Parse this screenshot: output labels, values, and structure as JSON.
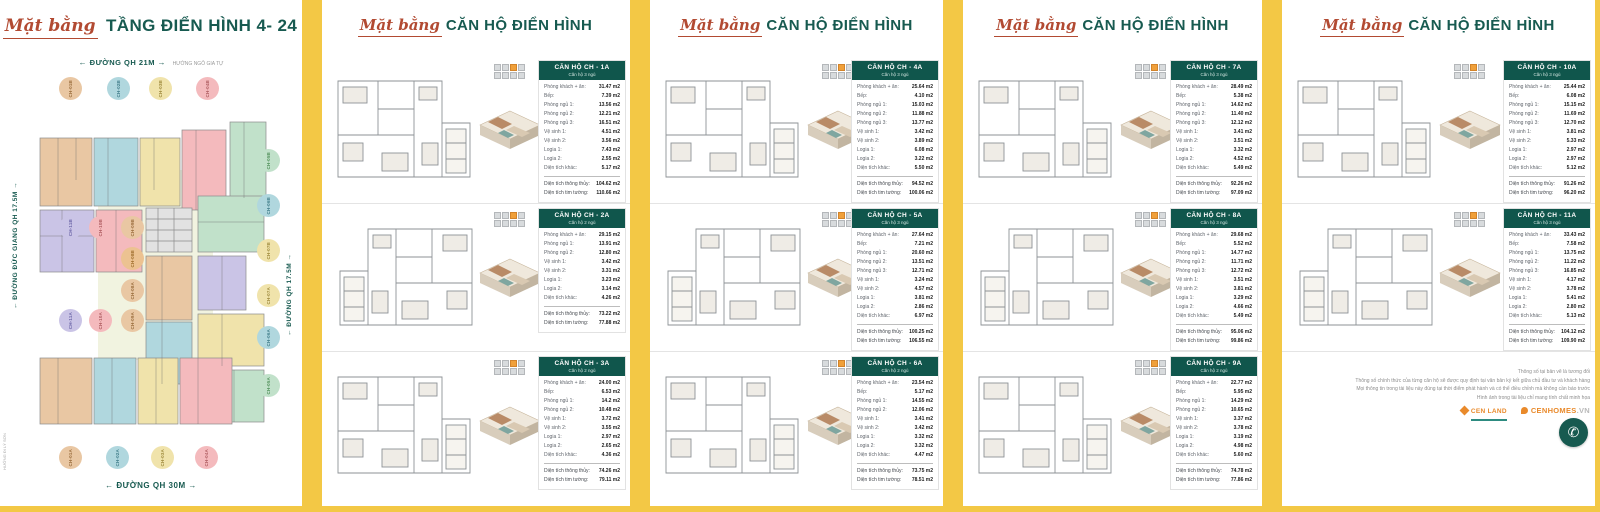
{
  "colors": {
    "yellow": "#f3c845",
    "teal": "#175a50",
    "script_red": "#b24a32",
    "orange": "#e98a2b",
    "header_teal": "#10564c"
  },
  "left_panel": {
    "title_script": "Mặt bằng",
    "title_main": "TẦNG ĐIỂN HÌNH 4- 24",
    "street_top": "ĐƯỜNG QH 21M",
    "street_top_note": "HƯỚNG NGÔ GIA TỰ",
    "street_bottom": "ĐƯỜNG QH 30M",
    "street_left": "ĐƯỜNG ĐỨC GIANG QH 17.5M",
    "street_left_note": "HƯỚNG ĐI LÝ SƠN",
    "street_right": "ĐƯỜNG QH 17.5M",
    "bubbles": [
      {
        "label": "CH-01B",
        "c": "tan",
        "x": 70,
        "y": 88
      },
      {
        "label": "CH-02B",
        "c": "blue",
        "x": 118,
        "y": 88
      },
      {
        "label": "CH-03B",
        "c": "yellow",
        "x": 160,
        "y": 88
      },
      {
        "label": "CH-04B",
        "c": "rose",
        "x": 207,
        "y": 88
      },
      {
        "label": "CH-11B",
        "c": "purple",
        "x": 70,
        "y": 227
      },
      {
        "label": "CH-10B",
        "c": "rose",
        "x": 100,
        "y": 227
      },
      {
        "label": "CH-09B",
        "c": "tan",
        "x": 132,
        "y": 227
      },
      {
        "label": "CH-08B",
        "c": "orange",
        "x": 132,
        "y": 258
      },
      {
        "label": "CH-08A",
        "c": "tan",
        "x": 132,
        "y": 290
      },
      {
        "label": "CH-11A",
        "c": "purple",
        "x": 70,
        "y": 320
      },
      {
        "label": "CH-10A",
        "c": "rose",
        "x": 100,
        "y": 320
      },
      {
        "label": "CH-09A",
        "c": "tan",
        "x": 132,
        "y": 320
      },
      {
        "label": "CH-05B",
        "c": "green",
        "x": 268,
        "y": 160
      },
      {
        "label": "CH-06B",
        "c": "blue",
        "x": 268,
        "y": 205
      },
      {
        "label": "CH-07B",
        "c": "yellow",
        "x": 268,
        "y": 250
      },
      {
        "label": "CH-07A",
        "c": "yellow",
        "x": 268,
        "y": 295
      },
      {
        "label": "CH-06A",
        "c": "blue",
        "x": 268,
        "y": 337
      },
      {
        "label": "CH-05A",
        "c": "green",
        "x": 268,
        "y": 385
      },
      {
        "label": "CH-01A",
        "c": "tan",
        "x": 70,
        "y": 457
      },
      {
        "label": "CH-02A",
        "c": "blue",
        "x": 117,
        "y": 457
      },
      {
        "label": "CH-03A",
        "c": "yellow",
        "x": 162,
        "y": 457
      },
      {
        "label": "CH-04A",
        "c": "rose",
        "x": 206,
        "y": 457
      }
    ]
  },
  "panels": [
    {
      "title_script": "Mặt bằng",
      "title_main": "CĂN HỘ ĐIỂN HÌNH",
      "units": [
        {
          "id": "CĂN HỘ CH - 1A",
          "subtitle": "Căn hộ 3 ngủ",
          "rows": [
            [
              "Phòng khách + ăn:",
              "31.47 m2"
            ],
            [
              "Bếp:",
              "7.39 m2"
            ],
            [
              "Phòng ngủ 1:",
              "13.56 m2"
            ],
            [
              "Phòng ngủ 2:",
              "12.21 m2"
            ],
            [
              "Phòng ngủ 3:",
              "16.51 m2"
            ],
            [
              "Vệ sinh 1:",
              "4.51 m2"
            ],
            [
              "Vệ sinh 2:",
              "3.56 m2"
            ],
            [
              "Logia 1:",
              "7.43 m2"
            ],
            [
              "Logia 2:",
              "2.55 m2"
            ],
            [
              "Diện tích khác:",
              "5.17 m2"
            ]
          ],
          "totals": [
            [
              "Diện tích thông thủy:",
              "104.62 m2"
            ],
            [
              "Diện tích tim tường:",
              "110.66 m2"
            ]
          ]
        },
        {
          "id": "CĂN HỘ CH - 2A",
          "subtitle": "Căn hộ 2 ngủ",
          "rows": [
            [
              "Phòng khách + ăn:",
              "29.15 m2"
            ],
            [
              "Phòng ngủ 1:",
              "13.91 m2"
            ],
            [
              "Phòng ngủ 2:",
              "12.80 m2"
            ],
            [
              "Vệ sinh 1:",
              "3.42 m2"
            ],
            [
              "Vệ sinh 2:",
              "3.31 m2"
            ],
            [
              "Logia 1:",
              "3.23 m2"
            ],
            [
              "Logia 2:",
              "3.14 m2"
            ],
            [
              "Diện tích khác:",
              "4.26 m2"
            ]
          ],
          "totals": [
            [
              "Diện tích thông thủy:",
              "73.22 m2"
            ],
            [
              "Diện tích tim tường:",
              "77.88 m2"
            ]
          ]
        },
        {
          "id": "CĂN HỘ CH - 3A",
          "subtitle": "Căn hộ 2 ngủ",
          "rows": [
            [
              "Phòng khách + ăn:",
              "24.00 m2"
            ],
            [
              "Bếp:",
              "6.53 m2"
            ],
            [
              "Phòng ngủ 1:",
              "14.2 m2"
            ],
            [
              "Phòng ngủ 2:",
              "10.48 m2"
            ],
            [
              "Vệ sinh 1:",
              "3.72 m2"
            ],
            [
              "Vệ sinh 2:",
              "3.55 m2"
            ],
            [
              "Logia 1:",
              "2.97 m2"
            ],
            [
              "Logia 2:",
              "2.65 m2"
            ],
            [
              "Diện tích khác:",
              "4.36 m2"
            ]
          ],
          "totals": [
            [
              "Diện tích thông thủy:",
              "74.26 m2"
            ],
            [
              "Diện tích tim tường:",
              "79.11 m2"
            ]
          ]
        }
      ]
    },
    {
      "title_script": "Mặt bằng",
      "title_main": "CĂN HỘ ĐIỂN HÌNH",
      "units": [
        {
          "id": "CĂN HỘ CH - 4A",
          "subtitle": "Căn hộ 3 ngủ",
          "rows": [
            [
              "Phòng khách + ăn:",
              "25.64 m2"
            ],
            [
              "Bếp:",
              "4.10 m2"
            ],
            [
              "Phòng ngủ 1:",
              "15.03 m2"
            ],
            [
              "Phòng ngủ 2:",
              "11.88 m2"
            ],
            [
              "Phòng ngủ 3:",
              "13.77 m2"
            ],
            [
              "Vệ sinh 1:",
              "3.42 m2"
            ],
            [
              "Vệ sinh 2:",
              "3.89 m2"
            ],
            [
              "Logia 1:",
              "6.08 m2"
            ],
            [
              "Logia 2:",
              "3.22 m2"
            ],
            [
              "Diện tích khác:",
              "5.50 m2"
            ]
          ],
          "totals": [
            [
              "Diện tích thông thủy:",
              "94.52 m2"
            ],
            [
              "Diện tích tim tường:",
              "100.06 m2"
            ]
          ]
        },
        {
          "id": "CĂN HỘ CH - 5A",
          "subtitle": "Căn hộ 3 ngủ",
          "rows": [
            [
              "Phòng khách + ăn:",
              "27.64 m2"
            ],
            [
              "Bếp:",
              "7.21 m2"
            ],
            [
              "Phòng ngủ 1:",
              "20.60 m2"
            ],
            [
              "Phòng ngủ 2:",
              "13.51 m2"
            ],
            [
              "Phòng ngủ 3:",
              "12.71 m2"
            ],
            [
              "Vệ sinh 1:",
              "3.24 m2"
            ],
            [
              "Vệ sinh 2:",
              "4.57 m2"
            ],
            [
              "Logia 1:",
              "3.81 m2"
            ],
            [
              "Logia 2:",
              "2.86 m2"
            ],
            [
              "Diện tích khác:",
              "6.97 m2"
            ]
          ],
          "totals": [
            [
              "Diện tích thông thủy:",
              "100.25 m2"
            ],
            [
              "Diện tích tim tường:",
              "106.55 m2"
            ]
          ]
        },
        {
          "id": "CĂN HỘ CH - 6A",
          "subtitle": "Căn hộ 2 ngủ",
          "rows": [
            [
              "Phòng khách + ăn:",
              "23.54 m2"
            ],
            [
              "Bếp:",
              "5.17 m2"
            ],
            [
              "Phòng ngủ 1:",
              "14.55 m2"
            ],
            [
              "Phòng ngủ 2:",
              "12.06 m2"
            ],
            [
              "Vệ sinh 1:",
              "3.41 m2"
            ],
            [
              "Vệ sinh 2:",
              "3.42 m2"
            ],
            [
              "Logia 1:",
              "3.32 m2"
            ],
            [
              "Logia 2:",
              "3.32 m2"
            ],
            [
              "Diện tích khác:",
              "4.47 m2"
            ]
          ],
          "totals": [
            [
              "Diện tích thông thủy:",
              "73.75 m2"
            ],
            [
              "Diện tích tim tường:",
              "78.51 m2"
            ]
          ]
        }
      ]
    },
    {
      "title_script": "Mặt bằng",
      "title_main": "CĂN HỘ ĐIỂN HÌNH",
      "units": [
        {
          "id": "CĂN HỘ CH - 7A",
          "subtitle": "Căn hộ 3 ngủ",
          "rows": [
            [
              "Phòng khách + ăn:",
              "28.49 m2"
            ],
            [
              "Bếp:",
              "5.38 m2"
            ],
            [
              "Phòng ngủ 1:",
              "14.62 m2"
            ],
            [
              "Phòng ngủ 2:",
              "11.40 m2"
            ],
            [
              "Phòng ngủ 3:",
              "12.12 m2"
            ],
            [
              "Vệ sinh 1:",
              "3.41 m2"
            ],
            [
              "Vệ sinh 2:",
              "3.51 m2"
            ],
            [
              "Logia 1:",
              "3.32 m2"
            ],
            [
              "Logia 2:",
              "4.52 m2"
            ],
            [
              "Diện tích khác:",
              "5.49 m2"
            ]
          ],
          "totals": [
            [
              "Diện tích thông thủy:",
              "92.26 m2"
            ],
            [
              "Diện tích tim tường:",
              "97.09 m2"
            ]
          ]
        },
        {
          "id": "CĂN HỘ CH - 8A",
          "subtitle": "Căn hộ 3 ngủ",
          "rows": [
            [
              "Phòng khách + ăn:",
              "29.68 m2"
            ],
            [
              "Bếp:",
              "5.52 m2"
            ],
            [
              "Phòng ngủ 1:",
              "14.77 m2"
            ],
            [
              "Phòng ngủ 2:",
              "11.71 m2"
            ],
            [
              "Phòng ngủ 3:",
              "12.72 m2"
            ],
            [
              "Vệ sinh 1:",
              "3.51 m2"
            ],
            [
              "Vệ sinh 2:",
              "3.81 m2"
            ],
            [
              "Logia 1:",
              "3.29 m2"
            ],
            [
              "Logia 2:",
              "4.66 m2"
            ],
            [
              "Diện tích khác:",
              "5.49 m2"
            ]
          ],
          "totals": [
            [
              "Diện tích thông thủy:",
              "95.06 m2"
            ],
            [
              "Diện tích tim tường:",
              "99.86 m2"
            ]
          ]
        },
        {
          "id": "CĂN HỘ CH - 9A",
          "subtitle": "Căn hộ 2 ngủ",
          "rows": [
            [
              "Phòng khách + ăn:",
              "22.77 m2"
            ],
            [
              "Bếp:",
              "5.95 m2"
            ],
            [
              "Phòng ngủ 1:",
              "14.29 m2"
            ],
            [
              "Phòng ngủ 2:",
              "10.65 m2"
            ],
            [
              "Vệ sinh 1:",
              "3.37 m2"
            ],
            [
              "Vệ sinh 2:",
              "3.78 m2"
            ],
            [
              "Logia 1:",
              "3.19 m2"
            ],
            [
              "Logia 2:",
              "4.98 m2"
            ],
            [
              "Diện tích khác:",
              "5.60 m2"
            ]
          ],
          "totals": [
            [
              "Diện tích thông thủy:",
              "74.78 m2"
            ],
            [
              "Diện tích tim tường:",
              "77.86 m2"
            ]
          ]
        }
      ]
    },
    {
      "title_script": "Mặt bằng",
      "title_main": "CĂN HỘ ĐIỂN HÌNH",
      "units": [
        {
          "id": "CĂN HỘ CH - 10A",
          "subtitle": "Căn hộ 3 ngủ",
          "rows": [
            [
              "Phòng khách + ăn:",
              "25.44 m2"
            ],
            [
              "Bếp:",
              "6.08 m2"
            ],
            [
              "Phòng ngủ 1:",
              "15.15 m2"
            ],
            [
              "Phòng ngủ 2:",
              "11.69 m2"
            ],
            [
              "Phòng ngủ 3:",
              "12.70 m2"
            ],
            [
              "Vệ sinh 1:",
              "3.81 m2"
            ],
            [
              "Vệ sinh 2:",
              "5.33 m2"
            ],
            [
              "Logia 1:",
              "2.97 m2"
            ],
            [
              "Logia 2:",
              "2.97 m2"
            ],
            [
              "Diện tích khác:",
              "5.12 m2"
            ]
          ],
          "totals": [
            [
              "Diện tích thông thủy:",
              "91.26 m2"
            ],
            [
              "Diện tích tim tường:",
              "96.20 m2"
            ]
          ]
        },
        {
          "id": "CĂN HỘ CH - 11A",
          "subtitle": "Căn hộ 3 ngủ",
          "rows": [
            [
              "Phòng khách + ăn:",
              "33.43 m2"
            ],
            [
              "Bếp:",
              "7.58 m2"
            ],
            [
              "Phòng ngủ 1:",
              "13.75 m2"
            ],
            [
              "Phòng ngủ 2:",
              "11.22 m2"
            ],
            [
              "Phòng ngủ 3:",
              "16.85 m2"
            ],
            [
              "Vệ sinh 1:",
              "4.17 m2"
            ],
            [
              "Vệ sinh 2:",
              "3.78 m2"
            ],
            [
              "Logia 1:",
              "5.41 m2"
            ],
            [
              "Logia 2:",
              "2.80 m2"
            ],
            [
              "Diện tích khác:",
              "5.13 m2"
            ]
          ],
          "totals": [
            [
              "Diện tích thông thủy:",
              "104.12 m2"
            ],
            [
              "Diện tích tim tường:",
              "109.90 m2"
            ]
          ]
        }
      ]
    }
  ],
  "footer": {
    "lines": [
      "Thông số tại bản vẽ là tương đối",
      "Thông số chính thức của từng căn hộ sẽ được quy định tại văn bản ký kết giữa chủ đầu tư và khách hàng",
      "Mọi thông tin trong tài liệu này đúng tại thời điểm phát hành và có thể điều chỉnh mà không cần báo trước",
      "Hình ảnh trong tài liệu chỉ mang tính chất minh họa"
    ],
    "logo_cenland": "CEN LAND",
    "logo_cenhomes": "CENHOMES",
    "logo_cenhomes_suffix": ".VN",
    "badge_icon": "phone-contact"
  }
}
